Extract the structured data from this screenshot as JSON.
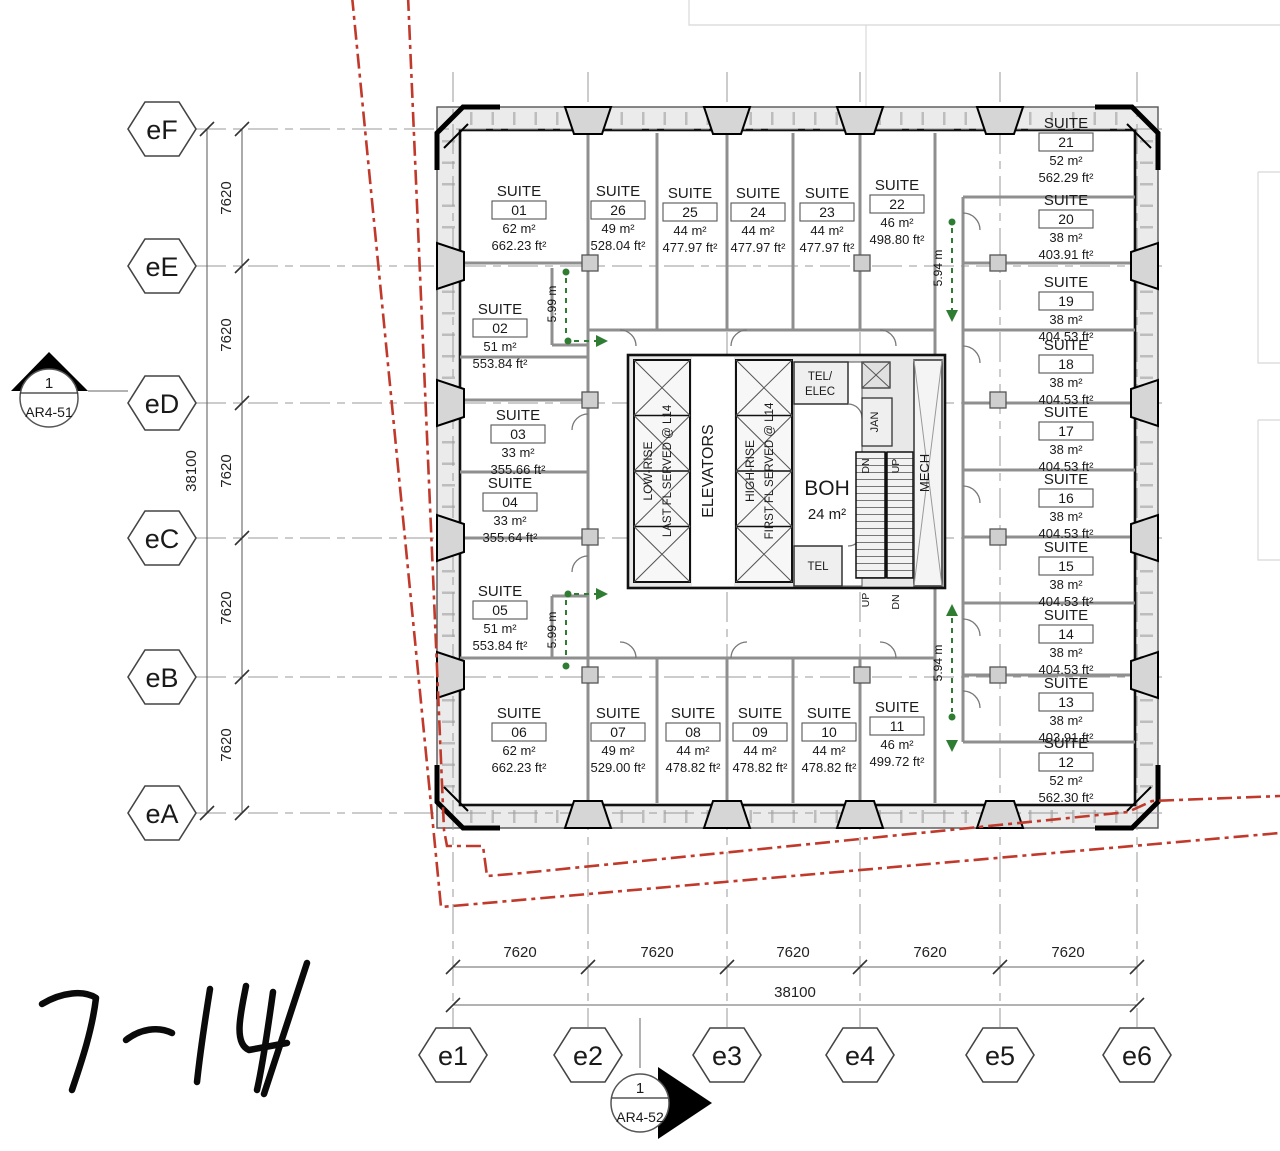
{
  "suite_label": "SUITE",
  "suites": [
    {
      "num": "01",
      "m2": "62 m²",
      "ft2": "662.23 ft²"
    },
    {
      "num": "02",
      "m2": "51 m²",
      "ft2": "553.84 ft²"
    },
    {
      "num": "03",
      "m2": "33 m²",
      "ft2": "355.66 ft²"
    },
    {
      "num": "04",
      "m2": "33 m²",
      "ft2": "355.64 ft²"
    },
    {
      "num": "05",
      "m2": "51 m²",
      "ft2": "553.84 ft²"
    },
    {
      "num": "06",
      "m2": "62 m²",
      "ft2": "662.23 ft²"
    },
    {
      "num": "07",
      "m2": "49 m²",
      "ft2": "529.00 ft²"
    },
    {
      "num": "08",
      "m2": "44 m²",
      "ft2": "478.82 ft²"
    },
    {
      "num": "09",
      "m2": "44 m²",
      "ft2": "478.82 ft²"
    },
    {
      "num": "10",
      "m2": "44 m²",
      "ft2": "478.82 ft²"
    },
    {
      "num": "11",
      "m2": "46 m²",
      "ft2": "499.72 ft²"
    },
    {
      "num": "12",
      "m2": "52 m²",
      "ft2": "562.30 ft²"
    },
    {
      "num": "13",
      "m2": "38 m²",
      "ft2": "403.91 ft²"
    },
    {
      "num": "14",
      "m2": "38 m²",
      "ft2": "404.53 ft²"
    },
    {
      "num": "15",
      "m2": "38 m²",
      "ft2": "404.53 ft²"
    },
    {
      "num": "16",
      "m2": "38 m²",
      "ft2": "404.53 ft²"
    },
    {
      "num": "17",
      "m2": "38 m²",
      "ft2": "404.53 ft²"
    },
    {
      "num": "18",
      "m2": "38 m²",
      "ft2": "404.53 ft²"
    },
    {
      "num": "19",
      "m2": "38 m²",
      "ft2": "404.53 ft²"
    },
    {
      "num": "20",
      "m2": "38 m²",
      "ft2": "403.91 ft²"
    },
    {
      "num": "21",
      "m2": "52 m²",
      "ft2": "562.29 ft²"
    },
    {
      "num": "22",
      "m2": "46 m²",
      "ft2": "498.80 ft²"
    },
    {
      "num": "23",
      "m2": "44 m²",
      "ft2": "477.97 ft²"
    },
    {
      "num": "24",
      "m2": "44 m²",
      "ft2": "477.97 ft²"
    },
    {
      "num": "25",
      "m2": "44 m²",
      "ft2": "477.97 ft²"
    },
    {
      "num": "26",
      "m2": "49 m²",
      "ft2": "528.04 ft²"
    }
  ],
  "core": {
    "elevators": "ELEVATORS",
    "low_rise_1": "LOW-RISE",
    "low_rise_2": "LAST FL SERVED @ L14",
    "high_rise_1": "HIGH-RISE",
    "high_rise_2": "FIRST FL SERVED @ L14",
    "boh_name": "BOH",
    "boh_area": "24 m²",
    "tel_elec_1": "TEL/",
    "tel_elec_2": "ELEC",
    "tel": "TEL",
    "jan": "JAN",
    "mech": "MECH",
    "up": "UP",
    "dn": "DN"
  },
  "grid": {
    "rows": [
      "eF",
      "eE",
      "eD",
      "eC",
      "eB",
      "eA"
    ],
    "cols": [
      "e1",
      "e2",
      "e3",
      "e4",
      "e5",
      "e6"
    ]
  },
  "dims": {
    "seg": "7620",
    "total": "38100"
  },
  "green": {
    "left": "5.99 m",
    "right": "5.94 m"
  },
  "markers": {
    "s1_num": "1",
    "s1_ref": "AR4-51",
    "s2_num": "1",
    "s2_ref": "AR4-52"
  },
  "annotation": {
    "handwritten": "7-14"
  },
  "colors": {
    "red": "#c0392b",
    "green": "#2e7d32",
    "wall_gray": "#8f8f8f",
    "band_gray": "#ebebeb"
  }
}
